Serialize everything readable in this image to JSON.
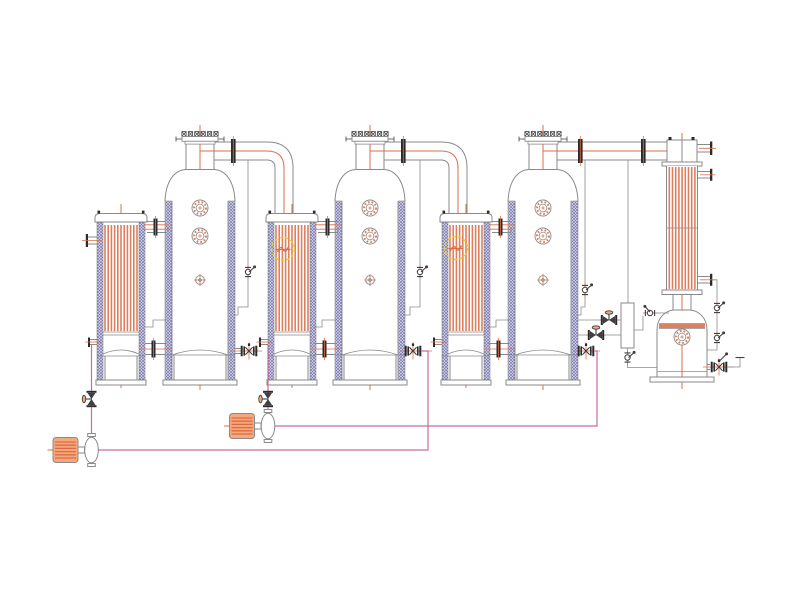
{
  "page": {
    "width": 800,
    "height": 600,
    "background": "#ffffff",
    "visible_text": []
  },
  "diagram": {
    "kind": "process-equipment-schematic",
    "description": "CAD-style schematic of a triple-effect evaporator line: three vertical tube heaters with separator vessels joined by elbowed vapor ducts, a shell-and-tube condenser, a condensate receiver tank, a level-gauge column, valves and two motor-driven transfer pumps.",
    "equipment": [
      {
        "name": "effect-1-heater"
      },
      {
        "name": "effect-1-evaporator"
      },
      {
        "name": "effect-2-heater"
      },
      {
        "name": "effect-2-evaporator"
      },
      {
        "name": "effect-3-heater"
      },
      {
        "name": "effect-3-evaporator"
      },
      {
        "name": "condenser"
      },
      {
        "name": "condensate-receiver"
      },
      {
        "name": "level-gauge-column"
      },
      {
        "name": "transfer-pump-1"
      },
      {
        "name": "transfer-pump-2"
      },
      {
        "name": "highlight-marker-heater-2"
      },
      {
        "name": "highlight-marker-heater-3"
      }
    ],
    "counts": {
      "evaporator_effects": 3,
      "pumps": 2,
      "highlight_markers": 2
    }
  },
  "colors": {
    "background": "#ffffff",
    "outline": "#8a8a8a",
    "dark": "#3f3f3f",
    "flange": "#2b2b2b",
    "tube": "#dc8060",
    "centerline": "#dd6f48",
    "wall_bg": "#c7c7e3",
    "wall_dot": "#50508e",
    "pipe_magenta": "#c96ba2",
    "motor_fill": "#f4a87e",
    "motor_stripe": "#e06a40",
    "marker_yellow": "#eed10a"
  }
}
